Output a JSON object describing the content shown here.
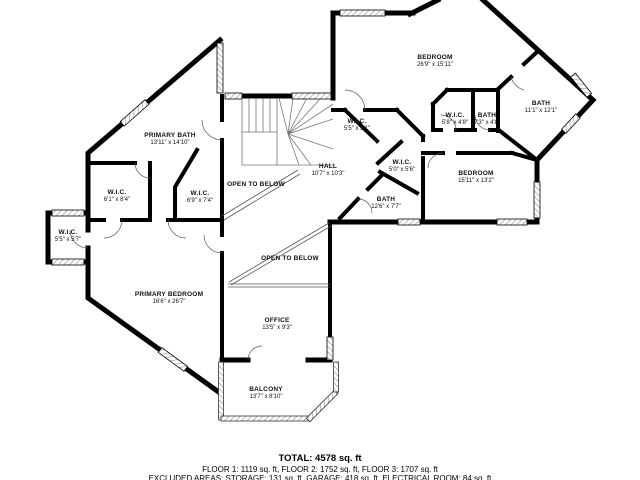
{
  "plan": {
    "title": "Third floor plan",
    "rooms": [
      {
        "name": "BEDROOM",
        "dims": "26'9\" x 15'11\""
      },
      {
        "name": "BATH",
        "dims": "11'1\" x 12'1\""
      },
      {
        "name": "W.I.C.",
        "dims": "5'8\" x 4'8\""
      },
      {
        "name": "BATH",
        "dims": "7'3\" x 4'8\""
      },
      {
        "name": "BEDROOM",
        "dims": "15'11\" x 13'2\""
      },
      {
        "name": "W.I.C.",
        "dims": "5'0\" x 5'6\""
      },
      {
        "name": "W.I.C.",
        "dims": "5'5\" x 3'1\""
      },
      {
        "name": "HALL",
        "dims": "10'7\" x 10'3\""
      },
      {
        "name": "BATH",
        "dims": "12'6\" x 7'7\""
      },
      {
        "name": "PRIMARY BATH",
        "dims": "13'11\" x 14'10\""
      },
      {
        "name": "W.I.C.",
        "dims": "6'1\" x 8'4\""
      },
      {
        "name": "W.I.C.",
        "dims": "6'9\" x 7'4\""
      },
      {
        "name": "OPEN TO BELOW",
        "dims": ""
      },
      {
        "name": "W.I.C.",
        "dims": "5'5\" x 5'7\""
      },
      {
        "name": "PRIMARY BEDROOM",
        "dims": "16'6\" x 26'7\""
      },
      {
        "name": "OPEN TO BELOW",
        "dims": ""
      },
      {
        "name": "OFFICE",
        "dims": "13'5\" x 9'3\""
      },
      {
        "name": "BALCONY",
        "dims": "13'7\" x 8'10\""
      }
    ],
    "footer": {
      "total": "TOTAL: 4578 sq. ft",
      "floors": "FLOOR 1: 1119 sq. ft, FLOOR 2: 1752 sq. ft, FLOOR 3: 1707 sq. ft",
      "excluded": "EXCLUDED AREAS: STORAGE: 131 sq. ft, GARAGE: 418 sq. ft, ELECTRICAL ROOM: 84 sq. ft"
    },
    "colors": {
      "wall": "#000000",
      "background": "#ffffff",
      "thin_line": "#666666"
    }
  }
}
